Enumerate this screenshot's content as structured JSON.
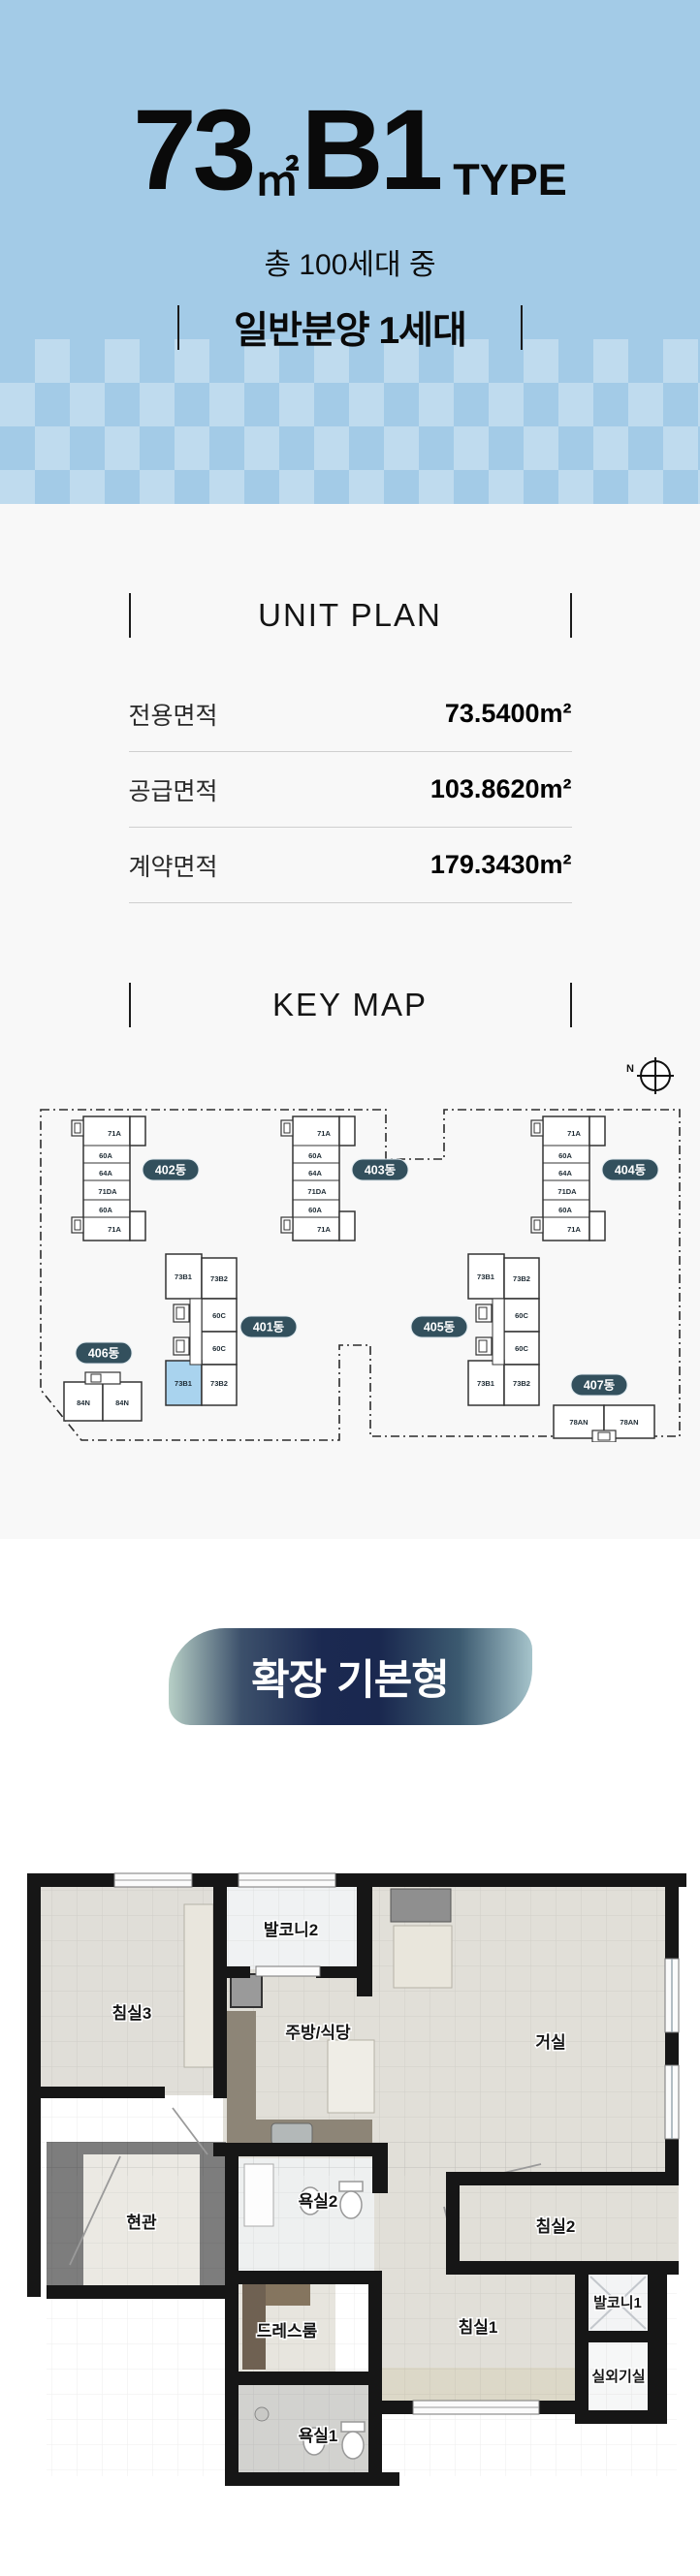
{
  "header": {
    "bg_color": "#a3cbe7",
    "title": {
      "area": "73",
      "unit": "㎡",
      "code": "B1",
      "suffix": "TYPE"
    },
    "subtitle": "총 100세대 중",
    "highlight": "일반분양 1세대"
  },
  "unit_plan": {
    "heading": "UNIT PLAN",
    "rows": [
      {
        "label": "전용면적",
        "value": "73.5400m²"
      },
      {
        "label": "공급면적",
        "value": "103.8620m²"
      },
      {
        "label": "계약면적",
        "value": "179.3430m²"
      }
    ]
  },
  "key_map": {
    "heading": "KEY MAP",
    "compass": "N",
    "badge_color": "#33505d",
    "highlight_color": "#a9d3ee",
    "buildings": [
      {
        "name": "402동",
        "units": [
          "71A",
          "60A",
          "64A",
          "71DA",
          "60A",
          "71A"
        ]
      },
      {
        "name": "403동",
        "units": [
          "71A",
          "60A",
          "64A",
          "71DA",
          "60A",
          "71A"
        ]
      },
      {
        "name": "404동",
        "units": [
          "71A",
          "60A",
          "64A",
          "71DA",
          "60A",
          "71A"
        ]
      },
      {
        "name": "401동",
        "units": [
          "73B1",
          "73B2",
          "60C",
          "60C",
          "73B1",
          "73B2"
        ],
        "highlighted_unit": "73B1"
      },
      {
        "name": "405동",
        "units": [
          "73B1",
          "73B2",
          "60C",
          "60C",
          "73B1",
          "73B2"
        ]
      },
      {
        "name": "406동",
        "units": [
          "84N",
          "84N"
        ]
      },
      {
        "name": "407동",
        "units": [
          "78AN",
          "78AN"
        ]
      }
    ]
  },
  "plan_type": {
    "badge": "확장 기본형"
  },
  "floorplan": {
    "rooms": [
      {
        "label": "발코니2"
      },
      {
        "label": "침실3"
      },
      {
        "label": "주방/식당"
      },
      {
        "label": "거실"
      },
      {
        "label": "현관"
      },
      {
        "label": "욕실2"
      },
      {
        "label": "침실2"
      },
      {
        "label": "드레스룸"
      },
      {
        "label": "침실1"
      },
      {
        "label": "발코니1"
      },
      {
        "label": "욕실1"
      },
      {
        "label": "실외기실"
      }
    ]
  }
}
